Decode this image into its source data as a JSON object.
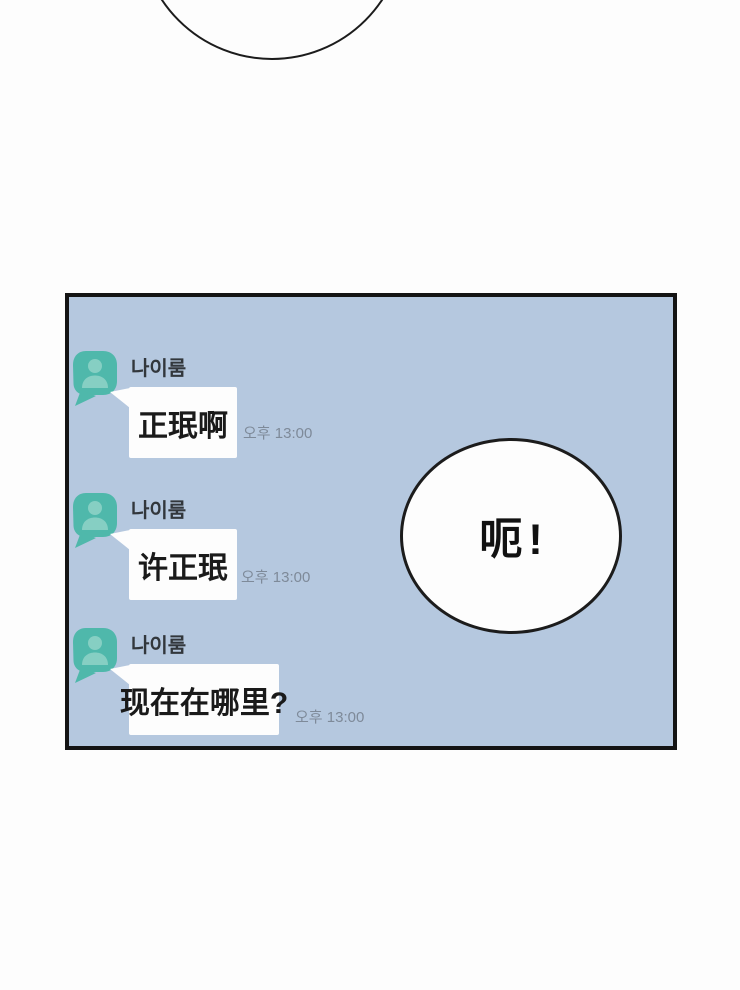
{
  "page": {
    "background_color": "#fdfdfd"
  },
  "top_bubble": {
    "shape": "partial-circle-speech-bubble",
    "text": ""
  },
  "panel": {
    "background_color": "#b5c8df",
    "border_color": "#141414",
    "chat": {
      "avatar": {
        "icon": "person-icon",
        "shape": "kakao-profile-bubble",
        "color": "#4fb8ab",
        "icon_color": "#86cfc3"
      },
      "bubble_color": "#fdfdfd",
      "name_color": "#32373c",
      "time_color": "#7e8a99",
      "messages": [
        {
          "sender": "나이룸",
          "text": "正珉啊",
          "time": "오후 13:00"
        },
        {
          "sender": "나이룸",
          "text": "许正珉",
          "time": "오후 13:00"
        },
        {
          "sender": "나이룸",
          "text": "现在在哪里?",
          "time": "오후 13:00"
        }
      ]
    },
    "shout_bubble": {
      "text": "呃!"
    }
  }
}
